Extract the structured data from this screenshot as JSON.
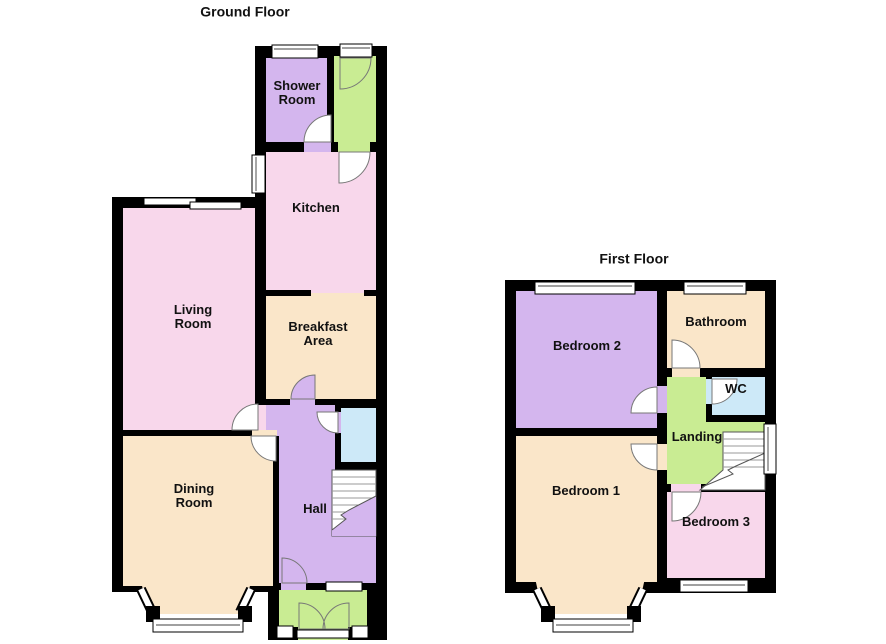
{
  "floors": {
    "ground": {
      "title": "Ground Floor",
      "rooms": {
        "shower": "Shower Room",
        "kitchen": "Kitchen",
        "living": "Living Room",
        "breakfast": "Breakfast Area",
        "dining": "Dining Room",
        "hall": "Hall"
      }
    },
    "first": {
      "title": "First Floor",
      "rooms": {
        "bedroom2": "Bedroom 2",
        "bathroom": "Bathroom",
        "wc": "WC",
        "landing": "Landing",
        "bedroom1": "Bedroom 1",
        "bedroom3": "Bedroom 3"
      }
    }
  },
  "colors": {
    "wall": "#000000",
    "purple": "#d4b6ee",
    "pink": "#f8d7eb",
    "cream": "#fae6c9",
    "green": "#c9ec93",
    "blue": "#cde9f8",
    "window": "#ffffff",
    "stairs": "#ffffff"
  }
}
